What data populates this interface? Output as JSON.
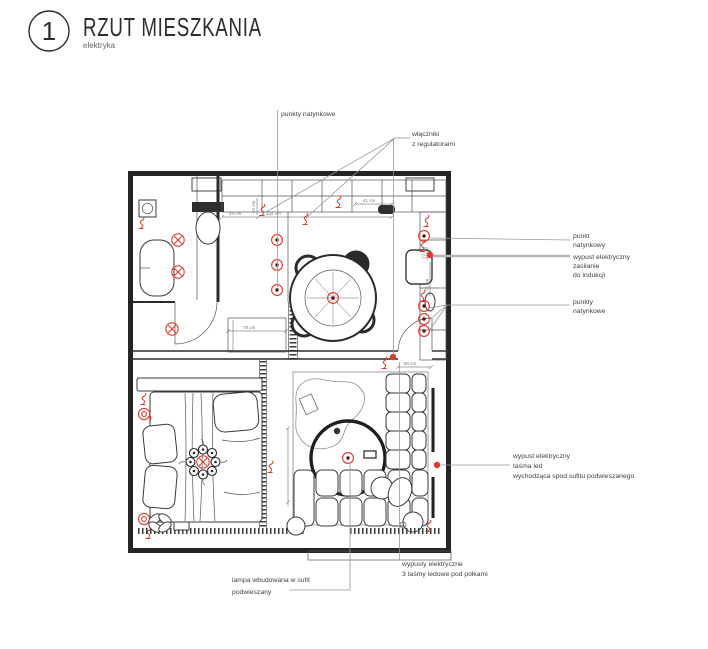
{
  "title_block": {
    "number": "1",
    "title": "RZUT MIESZKANIA",
    "subtitle": "elektryka"
  },
  "colors": {
    "line": "#2b2b2b",
    "red": "#e03a2a",
    "red_dark": "#5a160e",
    "leader": "#999999",
    "dim_text": "#777777"
  },
  "annotations": {
    "punkty_natynkowe_top": {
      "lines": [
        "punkty natynkowe"
      ]
    },
    "wlaczniki": {
      "lines": [
        "włączniki",
        "z regulatorami"
      ]
    },
    "punkt_natynkowy": {
      "lines": [
        "punkt",
        "natynkowy"
      ]
    },
    "wypust_indukcja": {
      "lines": [
        "wypust elektryczny",
        "zasilanie",
        "do indukcji"
      ]
    },
    "punkty_natynkowe_right": {
      "lines": [
        "punkty",
        "natynkowe"
      ]
    },
    "tasma_led": {
      "lines": [
        "wypust elektryczny",
        "taśma led",
        "wychodząca spod sufitu podwieszanego"
      ]
    },
    "wypusty_polki": {
      "lines": [
        "wypusty elektryczne",
        "3 taśmy ledowe pod półkami"
      ]
    },
    "lampa_sufit": {
      "lines": [
        "lampa wbudowana w sufit",
        "podwieszany"
      ]
    }
  },
  "dimensions": {
    "d44": "44 cm",
    "d134": "134 cm",
    "d41": "41 cm",
    "d62": "62 cm",
    "d78": "78 cm",
    "d80": "80 cm",
    "d27": "27 cm",
    "d75": "75 cm"
  }
}
